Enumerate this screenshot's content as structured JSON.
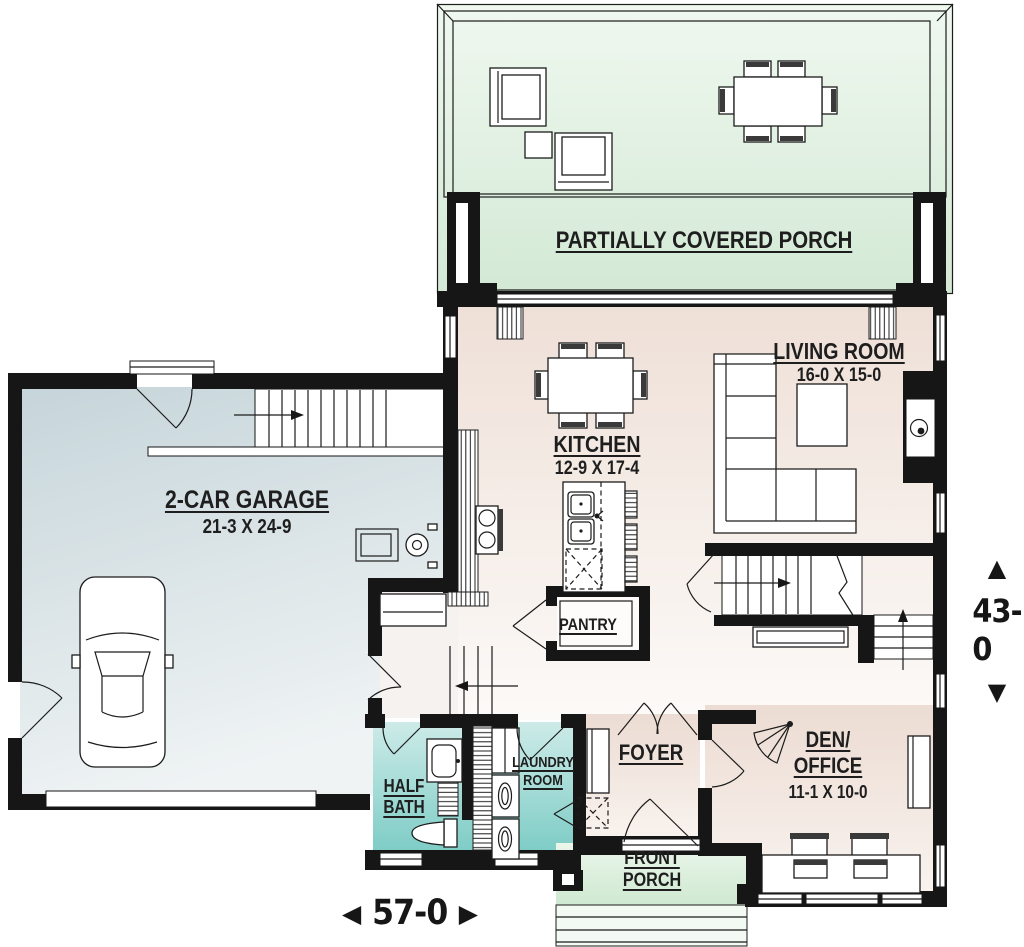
{
  "rooms": {
    "partially_covered_porch": {
      "name": "PARTIALLY COVERED PORCH"
    },
    "living_room": {
      "name": "LIVING ROOM",
      "dims": "16-0 X 15-0"
    },
    "kitchen": {
      "name": "KITCHEN",
      "dims": "12-9 X 17-4"
    },
    "garage": {
      "name": "2-CAR GARAGE",
      "dims": "21-3 X 24-9"
    },
    "pantry": {
      "name": "PANTRY"
    },
    "half_bath": {
      "line1": "HALF",
      "line2": "BATH"
    },
    "laundry_room": {
      "line1": "LAUNDRY",
      "line2": "ROOM"
    },
    "foyer": {
      "name": "FOYER"
    },
    "den_office": {
      "line1": "DEN/",
      "line2": "OFFICE",
      "dims": "11-1 X 10-0"
    },
    "front_porch": {
      "line1": "FRONT",
      "line2": "PORCH"
    }
  },
  "dimensions": {
    "width": {
      "value": "57-0",
      "arrow_left": "◀",
      "arrow_right": "▶"
    },
    "height": {
      "value": "43-0",
      "arrow_up": "▲",
      "arrow_down": "▼"
    }
  },
  "colors": {
    "wall_black": "#161616",
    "porch_green": "#ddeedd",
    "interior_beige": "#eedfd6",
    "garage_blue_gray": "#ccdade",
    "bath_teal": "#8fd2cc",
    "front_porch_green": "#d9eeda"
  }
}
